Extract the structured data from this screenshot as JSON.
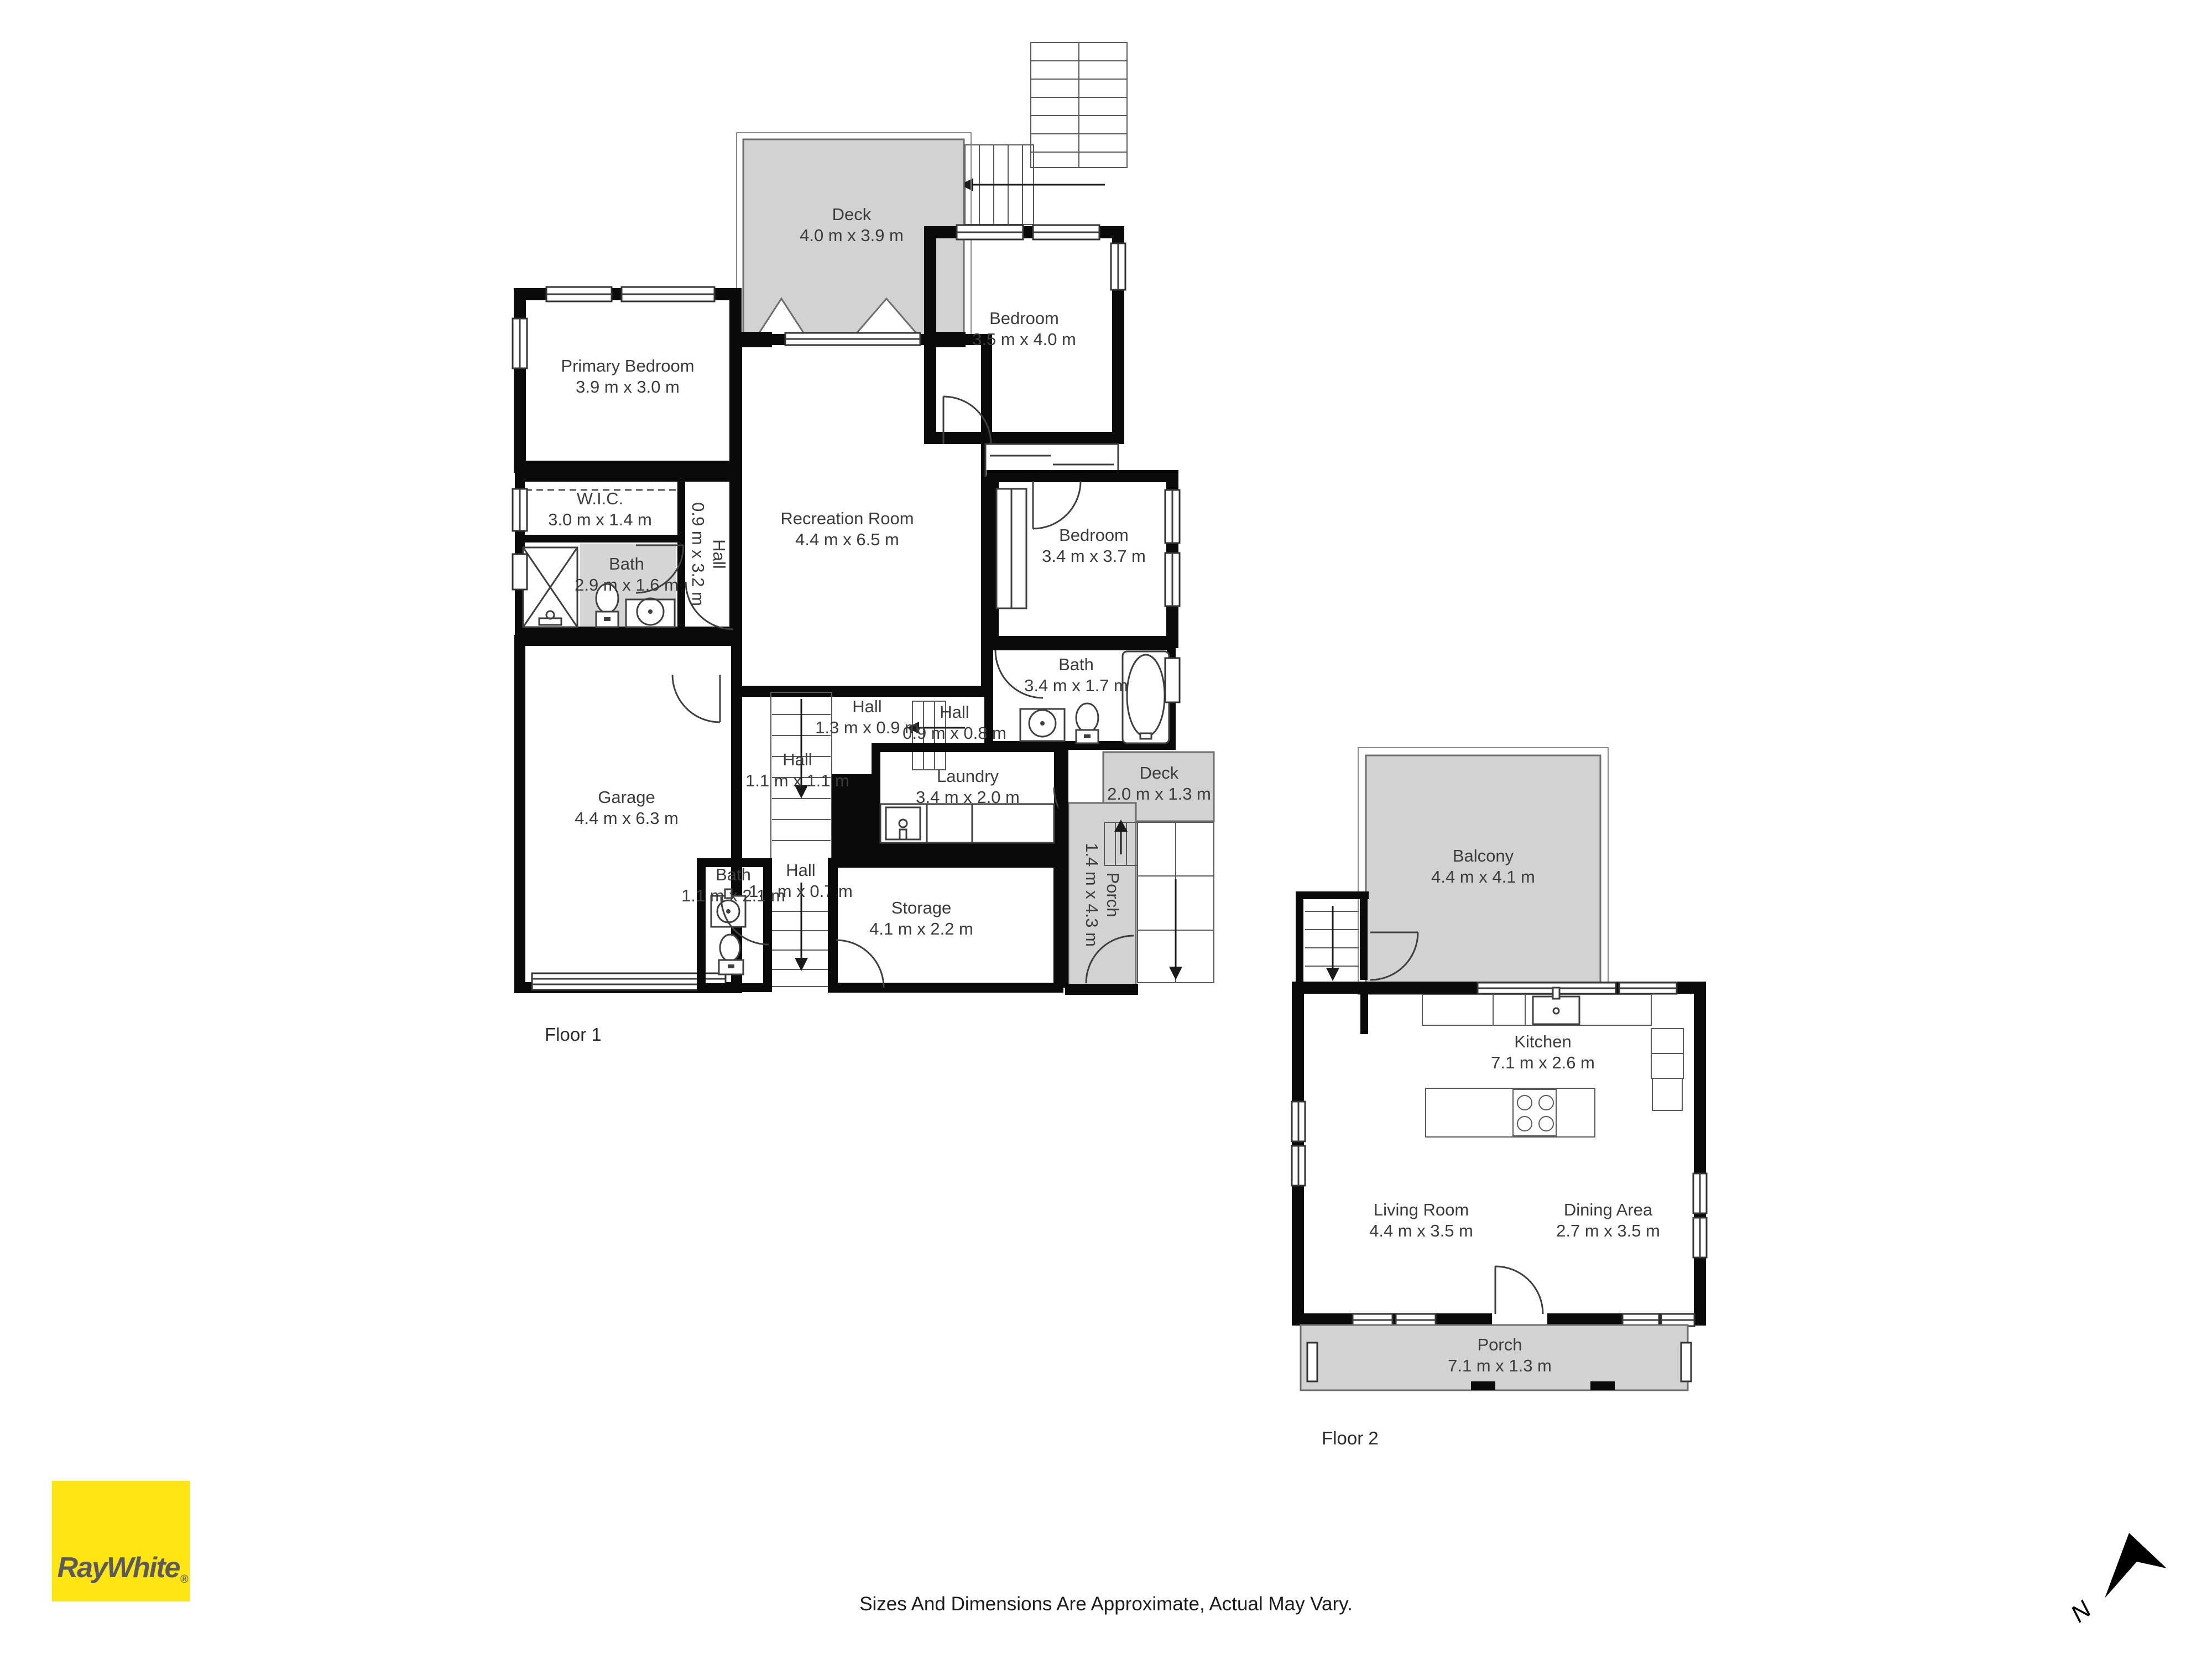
{
  "branding": {
    "logo_text": "RayWhite",
    "registered_mark": "®",
    "logo_bg": "#FFE512",
    "logo_text_color": "#5B5B5E"
  },
  "disclaimer": "Sizes And Dimensions Are Approximate, Actual May Vary.",
  "compass": {
    "north_label": "N"
  },
  "colors": {
    "room_highlight_yellow": "#FFE01A",
    "outdoor_gray": "#D2D2D2",
    "wet_room_gray": "#D6D6D6",
    "wall_black": "#0a0a0a",
    "label_text": "#3c3c3c"
  },
  "floor1": {
    "label": "Floor 1",
    "rooms": [
      {
        "name": "Deck",
        "dims": "4.0 m x 3.9 m"
      },
      {
        "name": "Primary Bedroom",
        "dims": "3.9 m x 3.0 m"
      },
      {
        "name": "Bedroom",
        "dims": "3.5 m x 4.0 m"
      },
      {
        "name": "Bedroom",
        "dims": "3.4 m x 3.7 m"
      },
      {
        "name": "W.I.C.",
        "dims": "3.0 m x 1.4 m"
      },
      {
        "name": "Bath",
        "dims": "2.9 m x 1.6 m"
      },
      {
        "name": "Hall",
        "dims": "0.9 m x 3.2 m"
      },
      {
        "name": "Recreation Room",
        "dims": "4.4 m x 6.5 m"
      },
      {
        "name": "Garage",
        "dims": "4.4 m x 6.3 m"
      },
      {
        "name": "Bath",
        "dims": "3.4 m x 1.7 m"
      },
      {
        "name": "Hall",
        "dims": "1.3 m x 0.9 m"
      },
      {
        "name": "Hall",
        "dims": "0.9 m x 0.8 m"
      },
      {
        "name": "Hall",
        "dims": "1.1 m x 1.1 m"
      },
      {
        "name": "Laundry",
        "dims": "3.4 m x 2.0 m"
      },
      {
        "name": "Deck",
        "dims": "2.0 m x 1.3 m"
      },
      {
        "name": "Porch",
        "dims": "1.4 m x 4.3 m"
      },
      {
        "name": "Bath",
        "dims": "1.1 m x 2.1 m"
      },
      {
        "name": "Hall",
        "dims": "1.1 m x 0.7 m"
      },
      {
        "name": "Storage",
        "dims": "4.1 m x 2.2 m"
      }
    ]
  },
  "floor2": {
    "label": "Floor 2",
    "rooms": [
      {
        "name": "Balcony",
        "dims": "4.4 m x 4.1 m"
      },
      {
        "name": "Kitchen",
        "dims": "7.1 m x 2.6 m"
      },
      {
        "name": "Living Room",
        "dims": "4.4 m x 3.5 m"
      },
      {
        "name": "Dining Area",
        "dims": "2.7 m x 3.5 m"
      },
      {
        "name": "Porch",
        "dims": "7.1 m x 1.3 m"
      }
    ]
  }
}
